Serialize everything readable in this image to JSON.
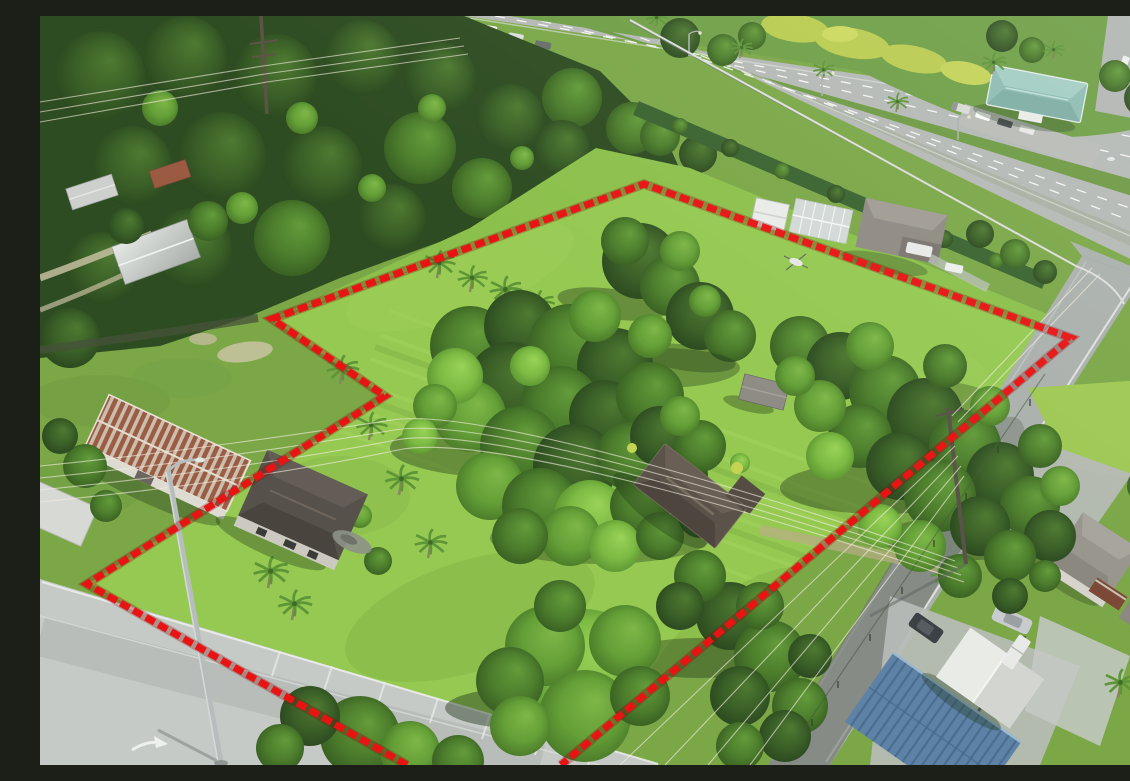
{
  "window": {
    "width": 1130,
    "height": 749
  },
  "scene": {
    "kind": "aerial-drone-photograph-of-vacant-corner-parcel",
    "boundary": {
      "color": "#e81414",
      "underglow_color": "#7f0b06",
      "stroke_width": 7,
      "dash": "10 4.5",
      "polyline_points": "367,749 47,568 345,380 232,303 604,168 1031,322 521,749"
    },
    "palette": {
      "lawn": "#95c952",
      "field": "#8cc04c",
      "base_grass": "#7ba747",
      "forest": "#2e4c22",
      "asphalt": "#b5b9b5",
      "side_road": "#aab0ac",
      "front_road": "#c6cac6",
      "teal_roof": "#8ebcb2",
      "rust_roof": "#9c5c42",
      "blue_roof": "#5e82a6",
      "dark_roof": "#5b5249",
      "canopy_white": "#e9ebe7"
    },
    "features": [
      {
        "name": "divided-highway",
        "position": "top",
        "detail": "grass median, guardrail, hedge row"
      },
      {
        "name": "teal-roof-commercial-building",
        "position": "top-right",
        "roof_color": "#8ebcb2"
      },
      {
        "name": "rust-striped-metal-roof-barn",
        "position": "left",
        "roof_color": "#9c5c42"
      },
      {
        "name": "gray-hip-roof-house",
        "position": "lower-left",
        "roof_color": "#56514b"
      },
      {
        "name": "central-house-in-trees",
        "position": "center",
        "roof_color": "#5b5249"
      },
      {
        "name": "white-sheds-and-greenhouse",
        "position": "upper-center"
      },
      {
        "name": "blue-metal-roof-building-with-white-canopy",
        "position": "bottom-right",
        "roof_color": "#5e82a6"
      },
      {
        "name": "corner-lot-roads",
        "detail": "front road lower-left, side road right"
      },
      {
        "name": "vehicles",
        "detail": "white cars on highway and driveways, dark SUV, silver sedan, white pickup"
      }
    ]
  }
}
